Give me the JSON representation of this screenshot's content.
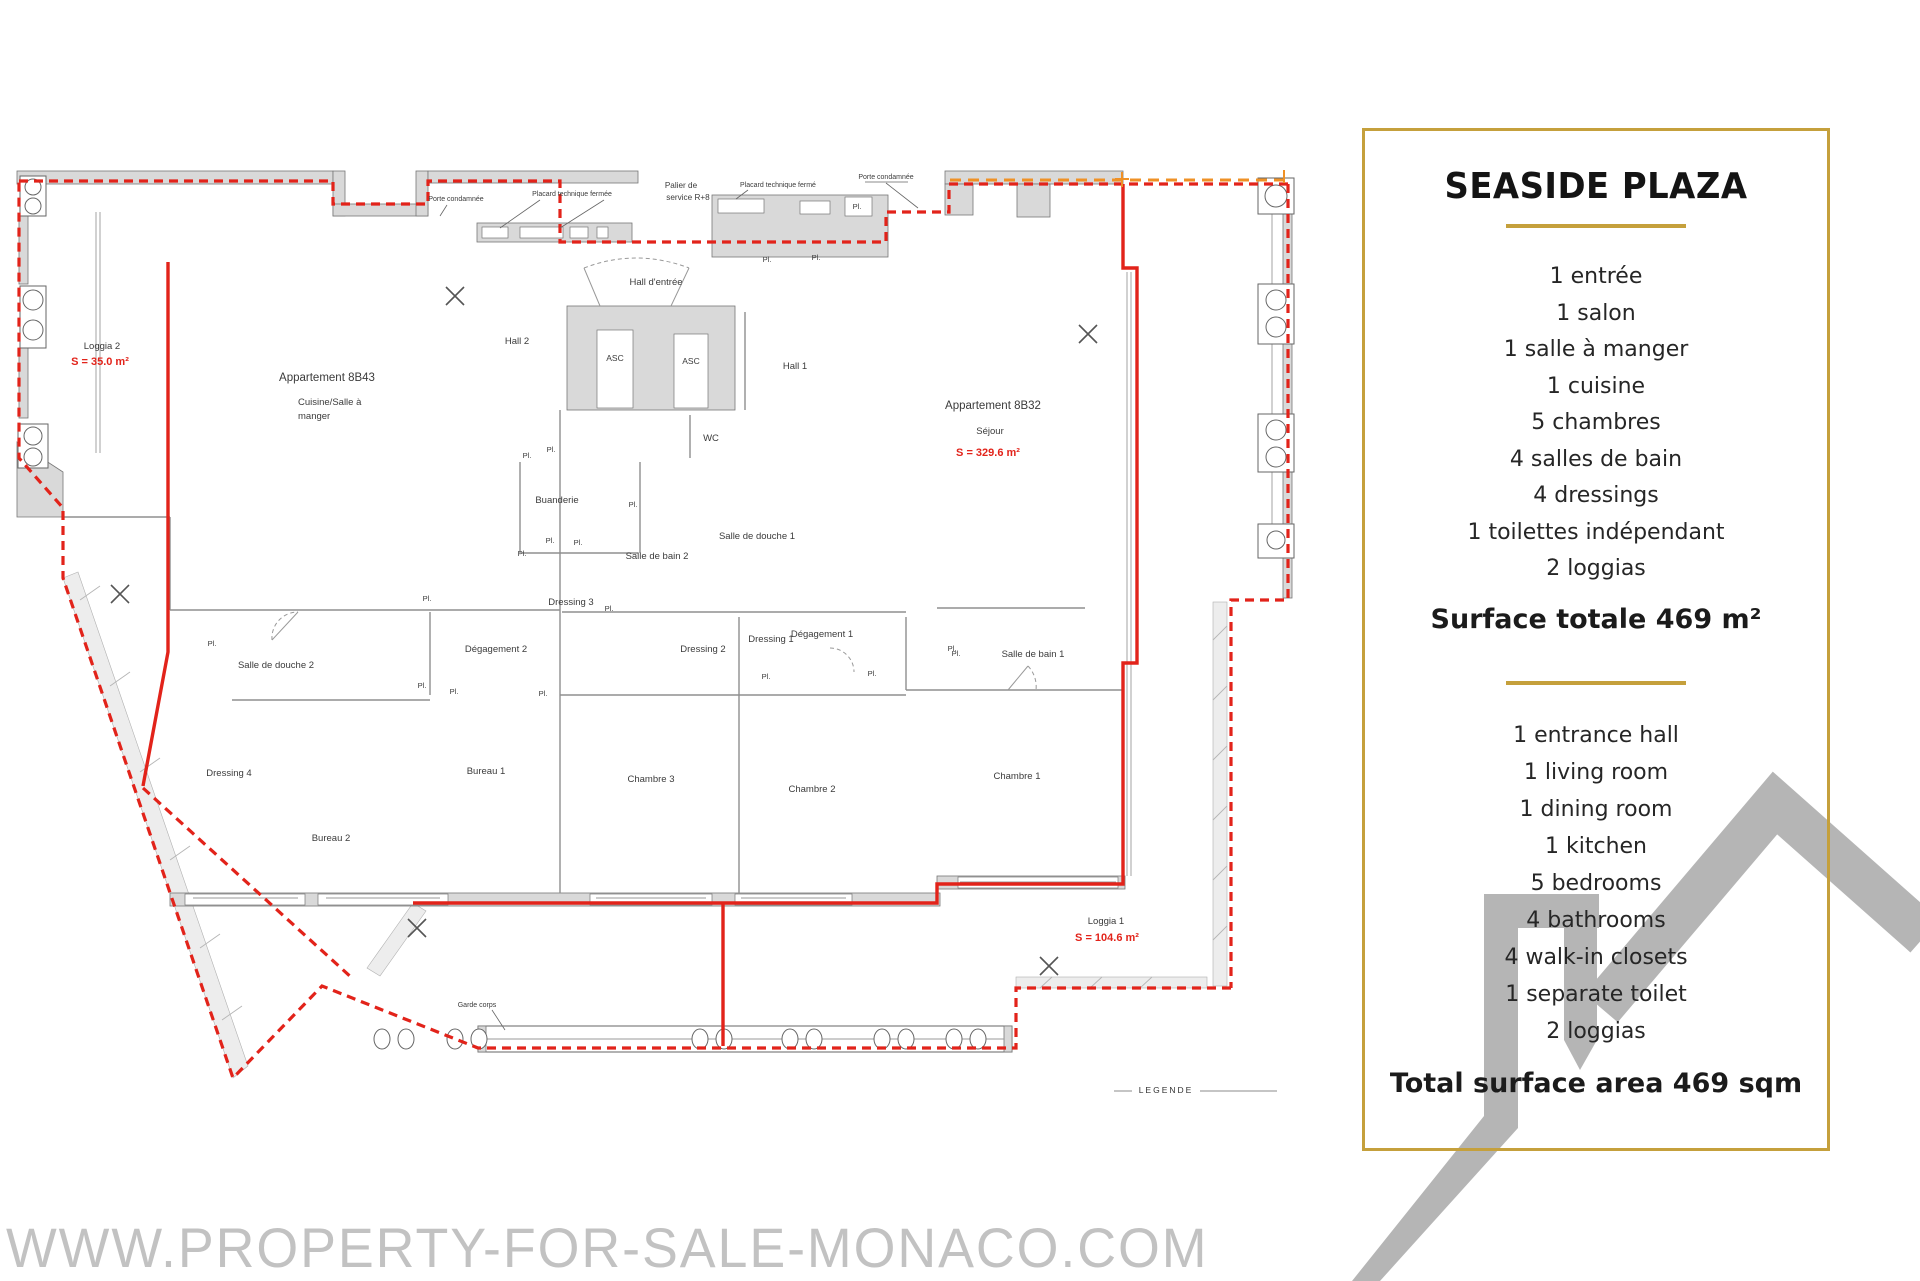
{
  "colors": {
    "gold": "#c5a03c",
    "red": "#e2231a",
    "orange": "#ef9126",
    "logo_gray": "#b5b5b5",
    "watermark_gray": "#c2c2c2",
    "wall_gray": "#d9d9d9"
  },
  "watermark": {
    "text": "WWW.PROPERTY-FOR-SALE-MONACO.COM"
  },
  "panel": {
    "title": "SEASIDE PLAZA",
    "french_items": [
      "1 entrée",
      "1 salon",
      "1 salle à manger",
      "1 cuisine",
      "5 chambres",
      "4 salles de bain",
      "4 dressings",
      "1 toilettes indépendant",
      "2 loggias"
    ],
    "surface_total_fr": "Surface totale 469 m²",
    "english_items": [
      "1 entrance hall",
      "1 living room",
      "1 dining room",
      "1 kitchen",
      "5 bedrooms",
      "4 bathrooms",
      "4 walk-in closets",
      "1 separate toilet",
      "2 loggias"
    ],
    "surface_total_en": "Total surface area 469 sqm"
  },
  "floor_plan": {
    "labels": [
      {
        "t": "Porte condamnée",
        "x": 456,
        "y": 201,
        "cls": "tiny",
        "n": "label-porte-condamnee-1"
      },
      {
        "t": "Placard technique fermée",
        "x": 572,
        "y": 196,
        "cls": "tiny",
        "n": "label-placard-technique-1"
      },
      {
        "t": "Palier de",
        "x": 681,
        "y": 188,
        "cls": "palier",
        "n": "label-palier-line1"
      },
      {
        "t": "service R+8",
        "x": 688,
        "y": 200,
        "cls": "palier",
        "n": "label-palier-line2"
      },
      {
        "t": "Placard technique fermé",
        "x": 778,
        "y": 187,
        "cls": "tiny",
        "n": "label-placard-technique-2"
      },
      {
        "t": "Porte condamnée",
        "x": 886,
        "y": 179,
        "cls": "tiny",
        "n": "label-porte-condamnee-2"
      },
      {
        "t": "Hall d'entrée",
        "x": 656,
        "y": 285,
        "cls": "room",
        "n": "label-hall-entree"
      },
      {
        "t": "Hall 2",
        "x": 517,
        "y": 344,
        "cls": "room",
        "n": "label-hall-2"
      },
      {
        "t": "Hall 1",
        "x": 795,
        "y": 369,
        "cls": "room",
        "n": "label-hall-1"
      },
      {
        "t": "ASC",
        "x": 615,
        "y": 361,
        "cls": "asc",
        "n": "label-asc-1"
      },
      {
        "t": "ASC",
        "x": 691,
        "y": 364,
        "cls": "asc",
        "n": "label-asc-2"
      },
      {
        "t": "WC",
        "x": 711,
        "y": 441,
        "cls": "room",
        "n": "label-wc"
      },
      {
        "t": "Loggia 2",
        "x": 102,
        "y": 349,
        "cls": "room",
        "n": "label-loggia-2"
      },
      {
        "t": "S = 35.0 m²",
        "x": 100,
        "y": 365,
        "cls": "red",
        "n": "label-loggia-2-area"
      },
      {
        "t": "Appartement 8B43",
        "x": 327,
        "y": 381,
        "cls": "roomlg",
        "n": "label-apartment-8b43"
      },
      {
        "t": "Cuisine/Salle à",
        "x": 298,
        "y": 405,
        "cls": "room",
        "a": "start",
        "n": "label-cuisine-line1"
      },
      {
        "t": "manger",
        "x": 298,
        "y": 419,
        "cls": "room",
        "a": "start",
        "n": "label-cuisine-line2"
      },
      {
        "t": "Appartement 8B32",
        "x": 993,
        "y": 409,
        "cls": "roomlg",
        "n": "label-apartment-8b32"
      },
      {
        "t": "Séjour",
        "x": 990,
        "y": 434,
        "cls": "room",
        "n": "label-sejour"
      },
      {
        "t": "S = 329.6 m²",
        "x": 988,
        "y": 456,
        "cls": "red",
        "n": "label-8b32-area"
      },
      {
        "t": "Buanderie",
        "x": 557,
        "y": 503,
        "cls": "room",
        "n": "label-buanderie"
      },
      {
        "t": "Salle de bain 2",
        "x": 657,
        "y": 559,
        "cls": "room",
        "n": "label-salle-de-bain-2"
      },
      {
        "t": "Salle de douche 1",
        "x": 757,
        "y": 539,
        "cls": "room",
        "n": "label-salle-de-douche-1"
      },
      {
        "t": "Dressing 3",
        "x": 571,
        "y": 605,
        "cls": "room",
        "n": "label-dressing-3"
      },
      {
        "t": "Dressing 2",
        "x": 703,
        "y": 652,
        "cls": "room",
        "n": "label-dressing-2"
      },
      {
        "t": "Dressing 1",
        "x": 771,
        "y": 642,
        "cls": "room",
        "n": "label-dressing-1"
      },
      {
        "t": "Dégagement 1",
        "x": 822,
        "y": 637,
        "cls": "room",
        "n": "label-degagement-1"
      },
      {
        "t": "Dégagement 2",
        "x": 496,
        "y": 652,
        "cls": "room",
        "n": "label-degagement-2"
      },
      {
        "t": "Salle de douche 2",
        "x": 276,
        "y": 668,
        "cls": "room",
        "n": "label-salle-de-douche-2"
      },
      {
        "t": "Dressing 4",
        "x": 229,
        "y": 776,
        "cls": "room",
        "n": "label-dressing-4"
      },
      {
        "t": "Bureau 1",
        "x": 486,
        "y": 774,
        "cls": "room",
        "n": "label-bureau-1"
      },
      {
        "t": "Bureau 2",
        "x": 331,
        "y": 841,
        "cls": "room",
        "n": "label-bureau-2"
      },
      {
        "t": "Chambre 3",
        "x": 651,
        "y": 782,
        "cls": "room",
        "n": "label-chambre-3"
      },
      {
        "t": "Chambre 2",
        "x": 812,
        "y": 792,
        "cls": "room",
        "n": "label-chambre-2"
      },
      {
        "t": "Chambre 1",
        "x": 1017,
        "y": 779,
        "cls": "room",
        "n": "label-chambre-1"
      },
      {
        "t": "Salle de bain 1",
        "x": 1033,
        "y": 657,
        "cls": "room",
        "n": "label-salle-de-bain-1"
      },
      {
        "t": "Loggia 1",
        "x": 1106,
        "y": 924,
        "cls": "room",
        "n": "label-loggia-1"
      },
      {
        "t": "S = 104.6 m²",
        "x": 1107,
        "y": 941,
        "cls": "red",
        "n": "label-loggia-1-area"
      },
      {
        "t": "Garde corps",
        "x": 477,
        "y": 1007,
        "cls": "tiny",
        "n": "label-garde-corps"
      },
      {
        "t": "LEGENDE",
        "x": 1166,
        "y": 1093,
        "cls": "legend",
        "n": "label-legende"
      },
      {
        "t": "Pl.",
        "x": 527,
        "y": 458,
        "cls": "pl",
        "n": "label-placard"
      },
      {
        "t": "Pl.",
        "x": 551,
        "y": 452,
        "cls": "pl",
        "n": "label-placard"
      },
      {
        "t": "Pl.",
        "x": 633,
        "y": 507,
        "cls": "pl",
        "n": "label-placard"
      },
      {
        "t": "Pl.",
        "x": 550,
        "y": 543,
        "cls": "pl",
        "n": "label-placard"
      },
      {
        "t": "Pl.",
        "x": 578,
        "y": 545,
        "cls": "pl",
        "n": "label-placard"
      },
      {
        "t": "Pl.",
        "x": 522,
        "y": 556,
        "cls": "pl",
        "n": "label-placard"
      },
      {
        "t": "Pl.",
        "x": 857,
        "y": 209,
        "cls": "pl",
        "n": "label-placard"
      },
      {
        "t": "Pl.",
        "x": 767,
        "y": 262,
        "cls": "pl",
        "n": "label-placard"
      },
      {
        "t": "Pl.",
        "x": 816,
        "y": 260,
        "cls": "pl",
        "n": "label-placard"
      },
      {
        "t": "Pl.",
        "x": 212,
        "y": 646,
        "cls": "pl",
        "n": "label-placard"
      },
      {
        "t": "Pl.",
        "x": 427,
        "y": 601,
        "cls": "pl",
        "n": "label-placard"
      },
      {
        "t": "Pl.",
        "x": 422,
        "y": 688,
        "cls": "pl",
        "n": "label-placard"
      },
      {
        "t": "Pl.",
        "x": 454,
        "y": 694,
        "cls": "pl",
        "n": "label-placard"
      },
      {
        "t": "Pl.",
        "x": 543,
        "y": 696,
        "cls": "pl",
        "n": "label-placard"
      },
      {
        "t": "Pl.",
        "x": 609,
        "y": 611,
        "cls": "pl",
        "n": "label-placard"
      },
      {
        "t": "Pl.",
        "x": 766,
        "y": 679,
        "cls": "pl",
        "n": "label-placard"
      },
      {
        "t": "Pl.",
        "x": 872,
        "y": 676,
        "cls": "pl",
        "n": "label-placard"
      },
      {
        "t": "Pl.",
        "x": 956,
        "y": 656,
        "cls": "pl",
        "n": "label-placard"
      },
      {
        "t": "Pl.",
        "x": 952,
        "y": 651,
        "cls": "pl",
        "n": "label-placard"
      }
    ]
  }
}
